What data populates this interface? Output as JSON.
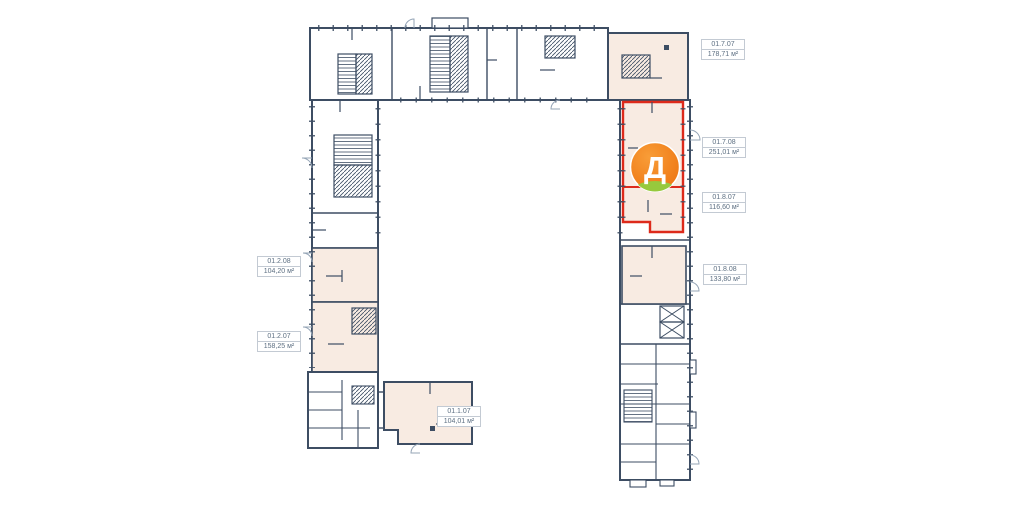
{
  "plan": {
    "colors": {
      "wall": "#3d4d63",
      "unit_fill": "#f8ebe2",
      "highlight": "#dd2a1b",
      "badge_orange": "#f1821c",
      "badge_orange_light": "#f89d38",
      "badge_green": "#97c93d",
      "label_border": "#c3cad3",
      "label_text": "#5d6f82",
      "door_arc": "#94a4b6"
    },
    "badge": {
      "letter": "Д"
    },
    "labels": [
      {
        "id": "01.7.07",
        "area": "178,71 м²",
        "x": 701,
        "y": 39
      },
      {
        "id": "01.7.08",
        "area": "251,01 м²",
        "x": 702,
        "y": 137
      },
      {
        "id": "01.8.07",
        "area": "116,60 м²",
        "x": 702,
        "y": 192
      },
      {
        "id": "01.8.08",
        "area": "133,80 м²",
        "x": 703,
        "y": 264
      },
      {
        "id": "01.2.08",
        "area": "104,20 м²",
        "x": 257,
        "y": 256
      },
      {
        "id": "01.2.07",
        "area": "158,25 м²",
        "x": 257,
        "y": 331
      },
      {
        "id": "01.1.07",
        "area": "104,01 м²",
        "x": 437,
        "y": 406
      }
    ]
  }
}
